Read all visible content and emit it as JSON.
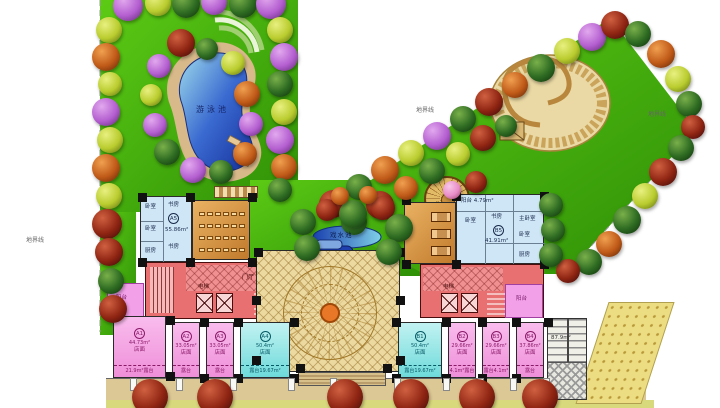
{
  "palette": {
    "lawn": "#3fae0a",
    "pool": "#2b59c3",
    "shop_pink": "#f49ae0",
    "shop_cyan": "#8ee6e6",
    "plaza_tan": "#ecd9a0",
    "corridor_red": "#e86868",
    "room_orange": "#dc9440",
    "apartment_blue": "#cfe6f7"
  },
  "site": {
    "pool_label": "游泳池",
    "water_feature_label": "戏水池",
    "boundary_label_left": "地界线",
    "boundary_label_mid": "地界线",
    "boundary_label_right": "地界线",
    "stairs_area_label": "87.9m²"
  },
  "apartment_left": {
    "unit": "A5",
    "area": "55.86m²",
    "rooms": {
      "bedroom_top": "卧室",
      "study_top": "书房",
      "bedroom_mid": "卧室",
      "study_bottom": "书房",
      "kitchen": "厨房"
    }
  },
  "apartment_right": {
    "unit": "B5",
    "area": "41.91m²",
    "balcony_label": "阳台",
    "balcony_area": "4.79m²",
    "rooms": {
      "bedroom_left": "卧室",
      "master": "主卧室",
      "bedroom_right": "卧室",
      "study": "书房",
      "kitchen": "厨房"
    }
  },
  "corridor": {
    "elevator_label": "电梯",
    "hall_label": "门厅",
    "elevator_label_right": "电梯",
    "balcony_left": "阳台",
    "balcony_right": "阳台"
  },
  "shops": [
    {
      "unit": "A1",
      "area": "44.73m²",
      "type_label": "店面",
      "terrace": "21.9m²露台"
    },
    {
      "unit": "A2",
      "area": "33.05m²",
      "type_label": "店面",
      "terrace": "露台4.75m²"
    },
    {
      "unit": "A3",
      "area": "33.05m²",
      "type_label": "店面",
      "terrace": "露台4.75m²"
    },
    {
      "unit": "A4",
      "area": "50.4m²",
      "type_label": "店面",
      "terrace": "露台19.67m²"
    },
    {
      "unit": "B1",
      "area": "50.4m²",
      "type_label": "店面",
      "terrace": "露台19.67m²"
    },
    {
      "unit": "B2",
      "area": "29.66m²",
      "type_label": "店面",
      "terrace": "4.1m²露台"
    },
    {
      "unit": "B3",
      "area": "29.66m²",
      "type_label": "店面",
      "terrace": "露台4.1m²"
    },
    {
      "unit": "B4",
      "area": "37.86m²",
      "type_label": "店面",
      "terrace": "露台5.95m²"
    }
  ]
}
